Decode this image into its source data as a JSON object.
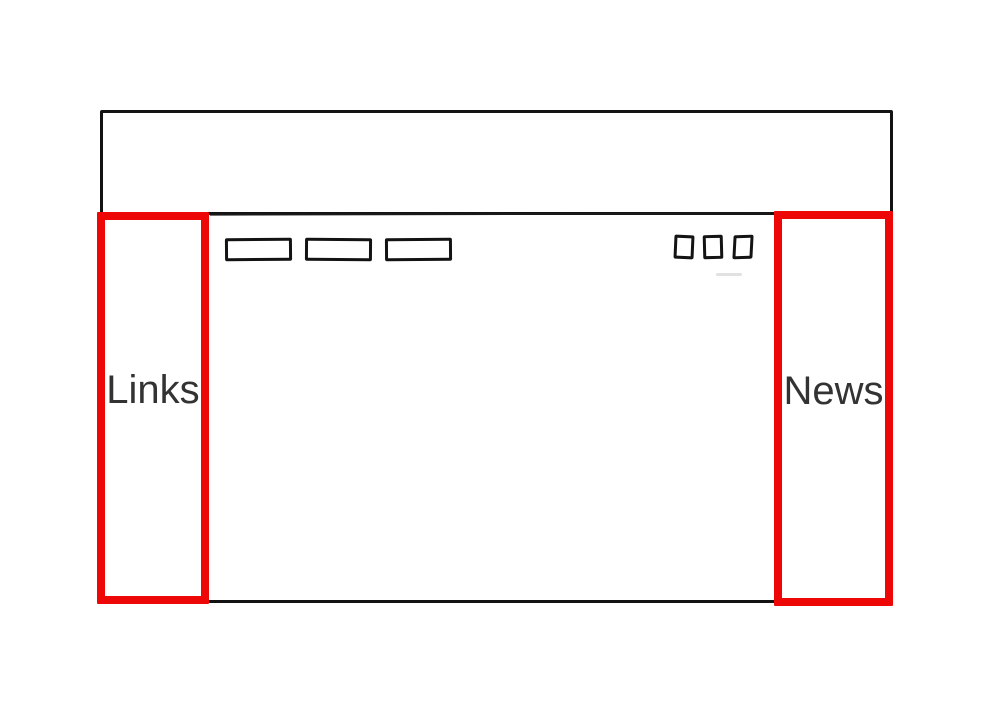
{
  "wireframe": {
    "sidebar_left": {
      "label": "Links"
    },
    "sidebar_right": {
      "label": "News"
    },
    "colors": {
      "annotation_red": "#ee0707",
      "sketch_black": "#131313",
      "label_gray": "#333333"
    }
  }
}
